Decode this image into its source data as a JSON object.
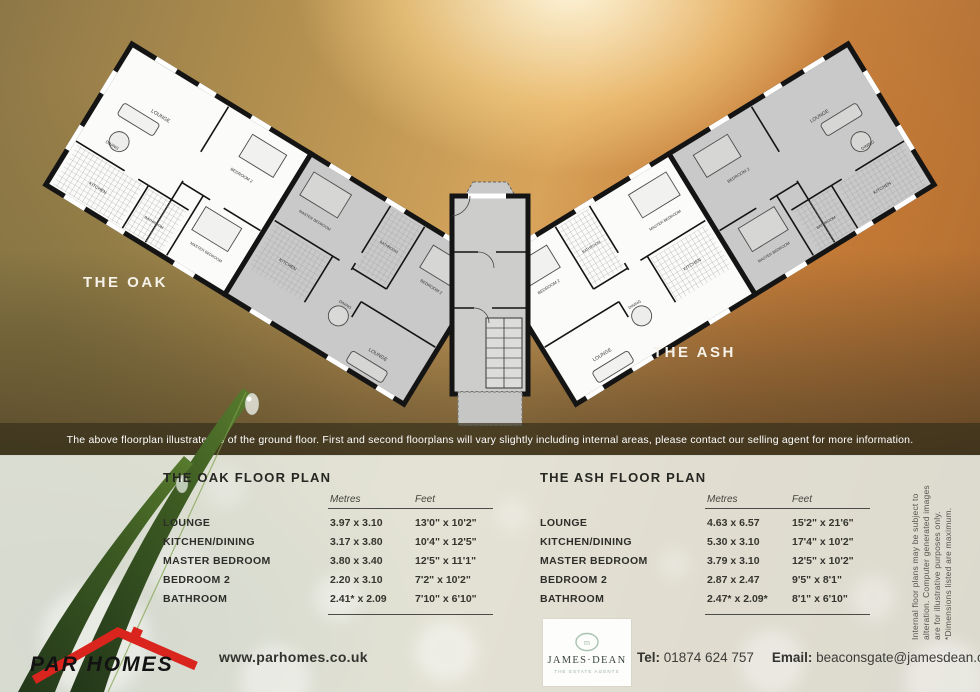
{
  "plan": {
    "oak_label": "THE OAK",
    "ash_label": "THE ASH",
    "rooms": {
      "lounge": "LOUNGE",
      "kitchen": "KITCHEN",
      "dining": "DINING",
      "bathroom": "BATHROOM",
      "master": "MASTER BEDROOM",
      "bedroom2": "BEDROOM 2"
    }
  },
  "disclaimer": "The above floorplan illustrated is of the ground floor.  First and second floorplans will vary slightly including internal areas, please contact our selling agent for more information.",
  "tables": {
    "oak": {
      "title": "THE OAK FLOOR PLAN",
      "col_metres": "Metres",
      "col_feet": "Feet",
      "rows": [
        {
          "label": "LOUNGE",
          "metres": "3.97 x 3.10",
          "feet": "13'0\" x 10'2\""
        },
        {
          "label": "KITCHEN/DINING",
          "metres": "3.17 x 3.80",
          "feet": "10'4\" x 12'5\""
        },
        {
          "label": "MASTER BEDROOM",
          "metres": "3.80 x 3.40",
          "feet": "12'5\" x 11'1\""
        },
        {
          "label": "BEDROOM 2",
          "metres": "2.20 x 3.10",
          "feet": "7'2\" x 10'2\""
        },
        {
          "label": "BATHROOM",
          "metres": "2.41* x 2.09",
          "feet": "7'10\" x 6'10\""
        }
      ]
    },
    "ash": {
      "title": "THE ASH FLOOR PLAN",
      "col_metres": "Metres",
      "col_feet": "Feet",
      "rows": [
        {
          "label": "LOUNGE",
          "metres": "4.63 x 6.57",
          "feet": "15'2\" x 21'6\""
        },
        {
          "label": "KITCHEN/DINING",
          "metres": "5.30 x 3.10",
          "feet": "17'4\" x 10'2\""
        },
        {
          "label": "MASTER BEDROOM",
          "metres": "3.79 x 3.10",
          "feet": "12'5\" x 10'2\""
        },
        {
          "label": "BEDROOM 2",
          "metres": "2.87 x 2.47",
          "feet": "9'5\" x 8'1\""
        },
        {
          "label": "BATHROOM",
          "metres": "2.47* x 2.09*",
          "feet": "8'1\" x 6'10\""
        }
      ]
    }
  },
  "side_note": {
    "line1": "Internal floor plans may be subject to",
    "line2": "alteration. Computer generated images",
    "line3": "are for illustrative purposes only.",
    "line4": "*Dimensions listed are maximum."
  },
  "footer": {
    "brand": "PAR HOMES",
    "website": "www.parhomes.co.uk",
    "agent_name": "JAMES·DEAN",
    "agent_tagline": "THE ESTATE AGENTS",
    "tel_label": "Tel:",
    "tel": "01874 624 757",
    "email_label": "Email:",
    "email": "beaconsgate@jamesdean.co.uk"
  },
  "colors": {
    "accent_red": "#d9251d",
    "wall_black": "#141414",
    "unit_gray": "#c9c9c9",
    "panel": "#e5ebe5",
    "band_brown": "#38301c"
  }
}
